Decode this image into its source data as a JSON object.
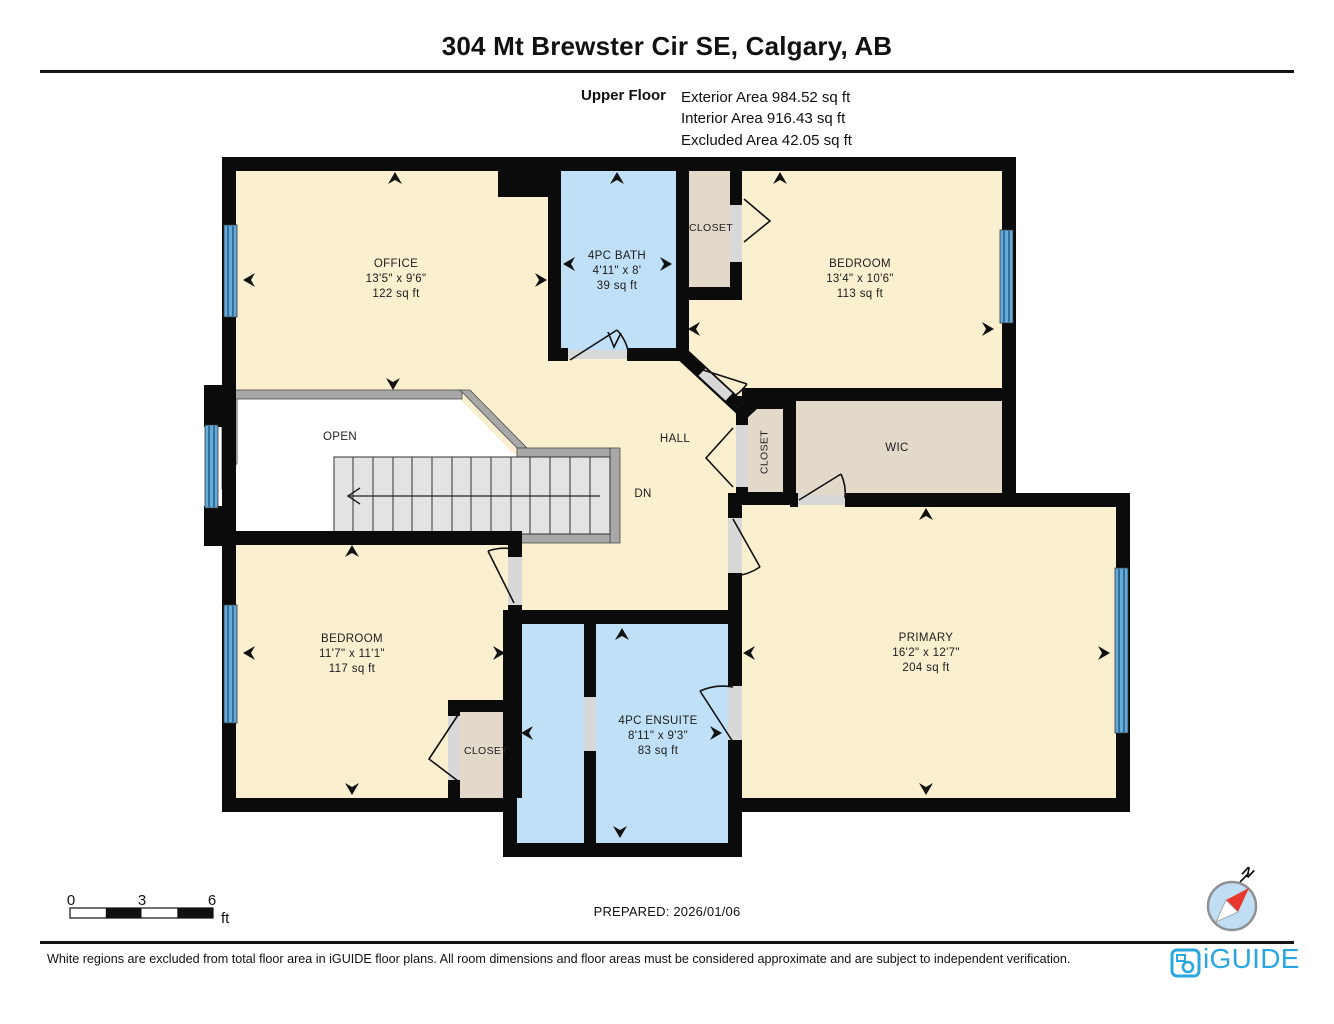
{
  "header": {
    "title": "304 Mt Brewster Cir SE, Calgary, AB",
    "floor_label": "Upper Floor",
    "areas": {
      "exterior": "Exterior Area 984.52 sq ft",
      "interior": "Interior Area 916.43 sq ft",
      "excluded": "Excluded Area 42.05 sq ft"
    }
  },
  "rooms": {
    "office": {
      "name": "OFFICE",
      "dims": "13'5\" x 9'6\"",
      "area": "122 sq ft"
    },
    "bath": {
      "name": "4PC BATH",
      "dims": "4'11\" x 8'",
      "area": "39 sq ft"
    },
    "closet_ne": {
      "name": "CLOSET"
    },
    "bedroom_ne": {
      "name": "BEDROOM",
      "dims": "13'4\" x 10'6\"",
      "area": "113 sq ft"
    },
    "open_below": {
      "name": "OPEN"
    },
    "hall": {
      "name": "HALL"
    },
    "stairs": {
      "name": "DN"
    },
    "closet_hall": {
      "name": "CLOSET"
    },
    "wic": {
      "name": "WIC"
    },
    "bedroom_sw": {
      "name": "BEDROOM",
      "dims": "11'7\" x 11'1\"",
      "area": "117 sq ft"
    },
    "closet_sw": {
      "name": "CLOSET"
    },
    "ensuite": {
      "name": "4PC ENSUITE",
      "dims": "8'11\" x 9'3\"",
      "area": "83 sq ft"
    },
    "primary": {
      "name": "PRIMARY",
      "dims": "16'2\" x 12'7\"",
      "area": "204 sq ft"
    }
  },
  "scale_bar": {
    "labels": [
      "0",
      "3",
      "6"
    ],
    "unit": "ft"
  },
  "prepared_label": "PREPARED: 2026/01/06",
  "compass": {
    "north": "N"
  },
  "footer": {
    "disclaimer": "White regions are excluded from total floor area in iGUIDE floor plans. All room dimensions and floor areas must be considered approximate and are subject to independent verification.",
    "brand": "iGUIDE"
  },
  "colors": {
    "room_fill": "#FAF0CF",
    "wet_room_fill": "#BFE0F6",
    "closet_fill": "#E2D9CB",
    "wall": "#0B0B0B",
    "window": "#5FA8D6",
    "stair_fill": "#E3E3E3",
    "railing": "#A8A8A8",
    "excluded_fill": "#FFFFFF",
    "brand_blue": "#2AA7DE",
    "compass_red": "#E8372C"
  }
}
